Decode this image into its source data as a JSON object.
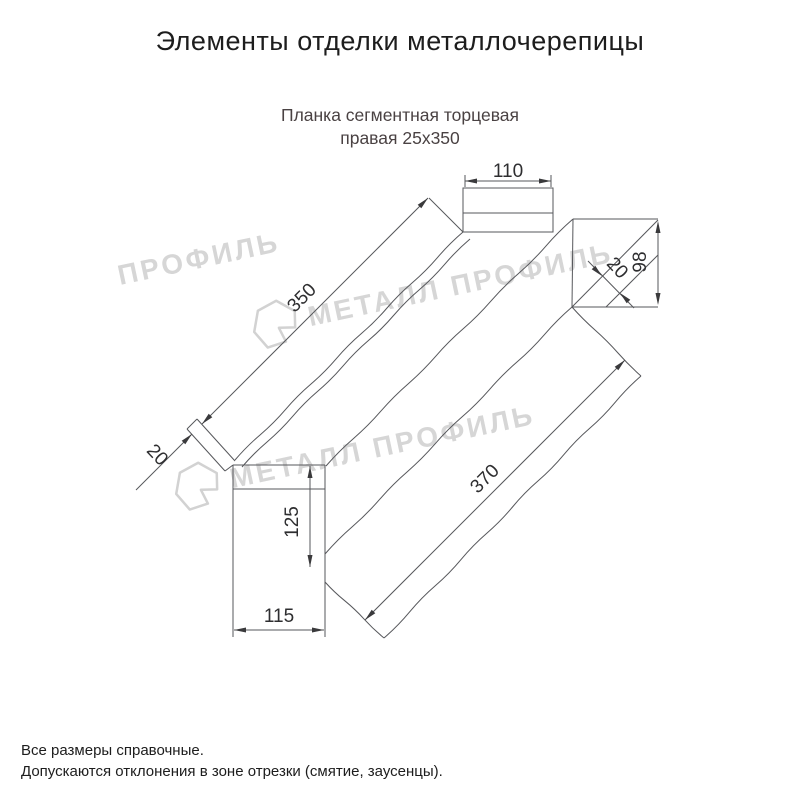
{
  "header": {
    "title": "Элементы отделки металлочерепицы"
  },
  "product": {
    "name_line1": "Планка сегментная торцевая",
    "name_line2": "правая 25х350"
  },
  "drawing": {
    "dim_top_width": "110",
    "dim_right_height": "98",
    "dim_right_flap": "20",
    "dim_length_upper": "350",
    "dim_left_flap": "20",
    "dim_tail_height": "125",
    "dim_tail_width": "115",
    "dim_length_lower": "370"
  },
  "watermark": {
    "text": "МЕТАЛЛ ПРОФИЛЬ",
    "fragment": "ПРОФИЛЬ",
    "logo_icon": "metall-profil-logo"
  },
  "footer": {
    "note1": "Все размеры справочные.",
    "note2": "Допускаются отклонения в зоне отрезки (смятие, заусенцы)."
  },
  "colors": {
    "line": "#56575b",
    "dim_text": "#2e2e30",
    "subtitle": "#4a4243",
    "watermark": "#d6d6d6"
  }
}
